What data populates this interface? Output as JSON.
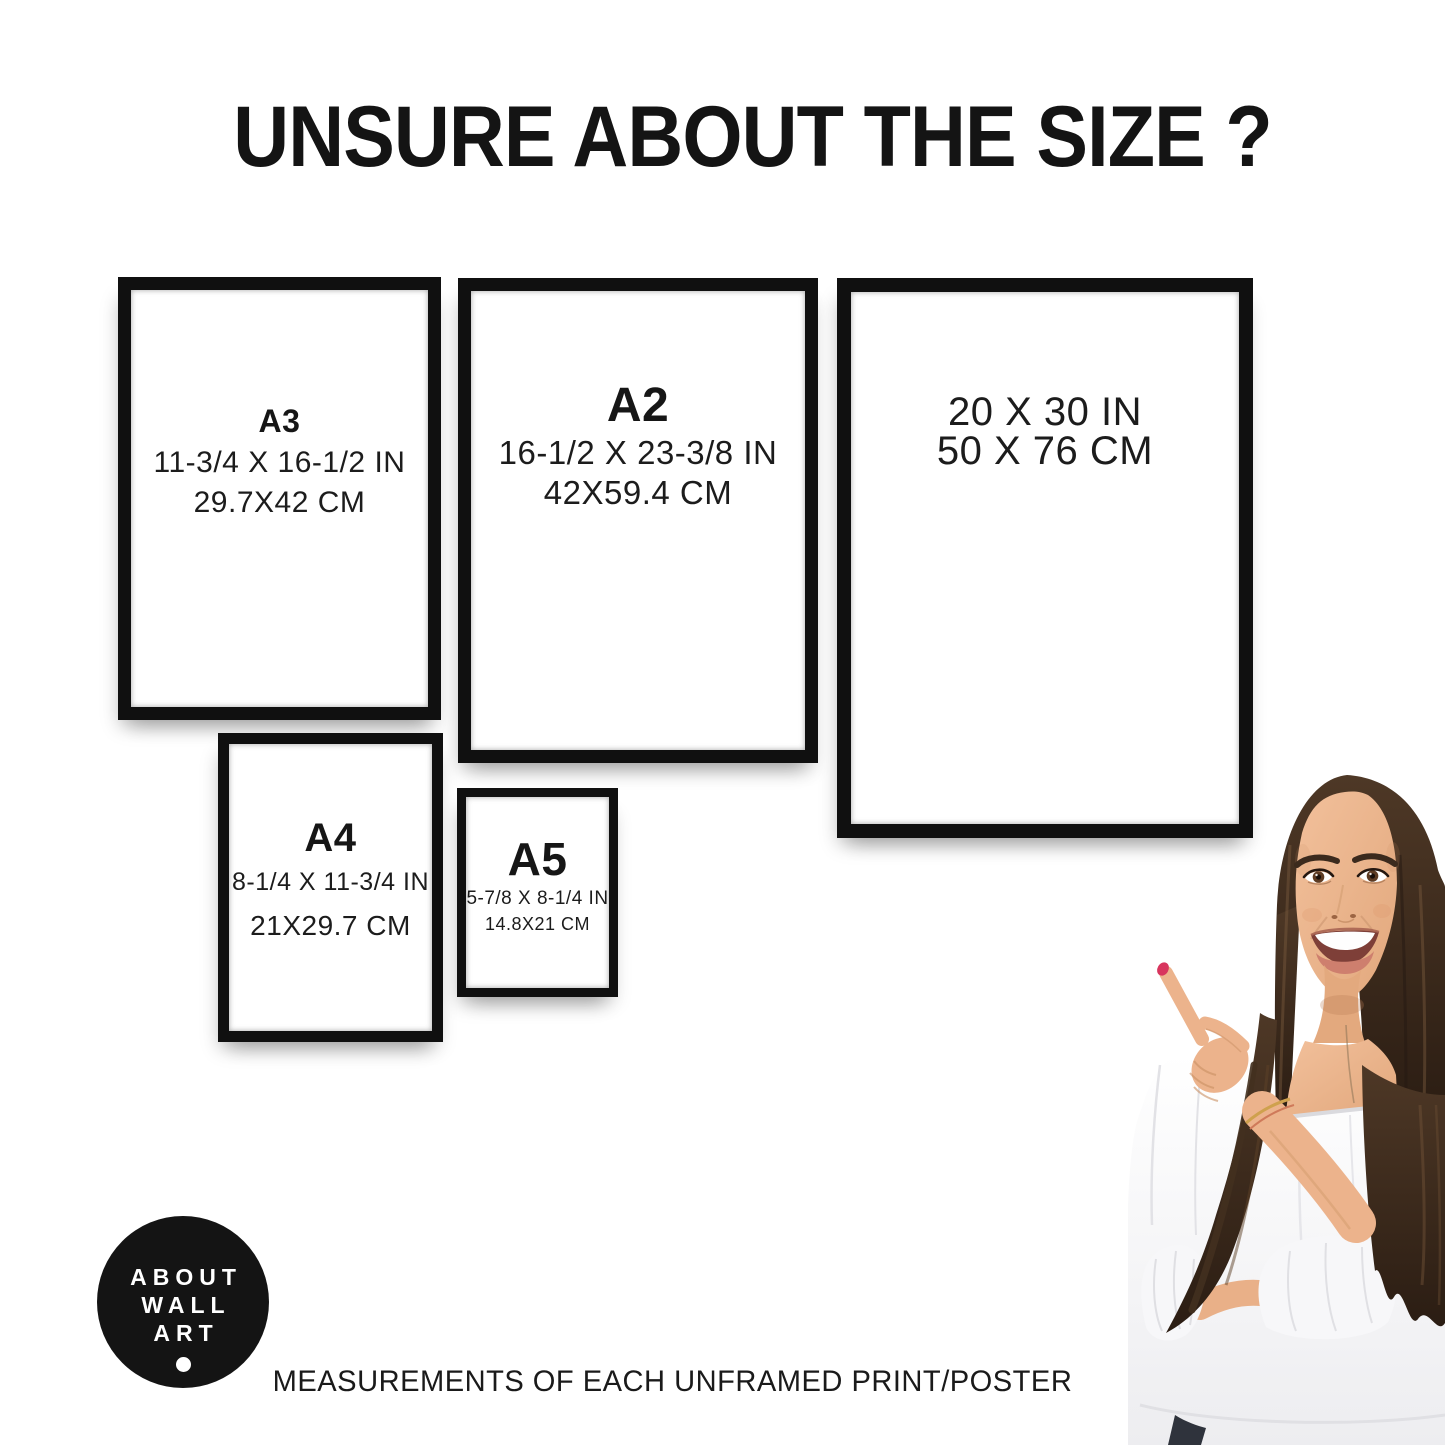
{
  "title": "UNSURE ABOUT THE SIZE ?",
  "caption": "MEASUREMENTS OF EACH UNFRAMED PRINT/POSTER",
  "frames": [
    {
      "id": "a3",
      "label": "A3",
      "line1": "11-3/4 X 16-1/2 IN",
      "line2": "29.7X42 CM"
    },
    {
      "id": "a2",
      "label": "A2",
      "line1": "16-1/2 X 23-3/8 IN",
      "line2": "42X59.4 CM"
    },
    {
      "id": "20x30",
      "label": "",
      "line1": "20 X 30 IN",
      "line2": "50 X 76 CM"
    },
    {
      "id": "a4",
      "label": "A4",
      "line1": "8-1/4 X 11-3/4 IN",
      "line2": "21X29.7 CM"
    },
    {
      "id": "a5",
      "label": "A5",
      "line1": "5-7/8 X 8-1/4 IN",
      "line2": "14.8X21 CM"
    }
  ],
  "logo": {
    "lines": [
      "ABOUT",
      "WALL",
      "ART"
    ]
  },
  "colors": {
    "background": "#ffffff",
    "frame_border": "#101010",
    "text": "#1c1c1c",
    "logo_background": "#141414",
    "logo_text": "#ffffff",
    "nail_polish": "#d8355e",
    "hair": "#3a2a1c",
    "blouse": "#f7f7f9"
  }
}
